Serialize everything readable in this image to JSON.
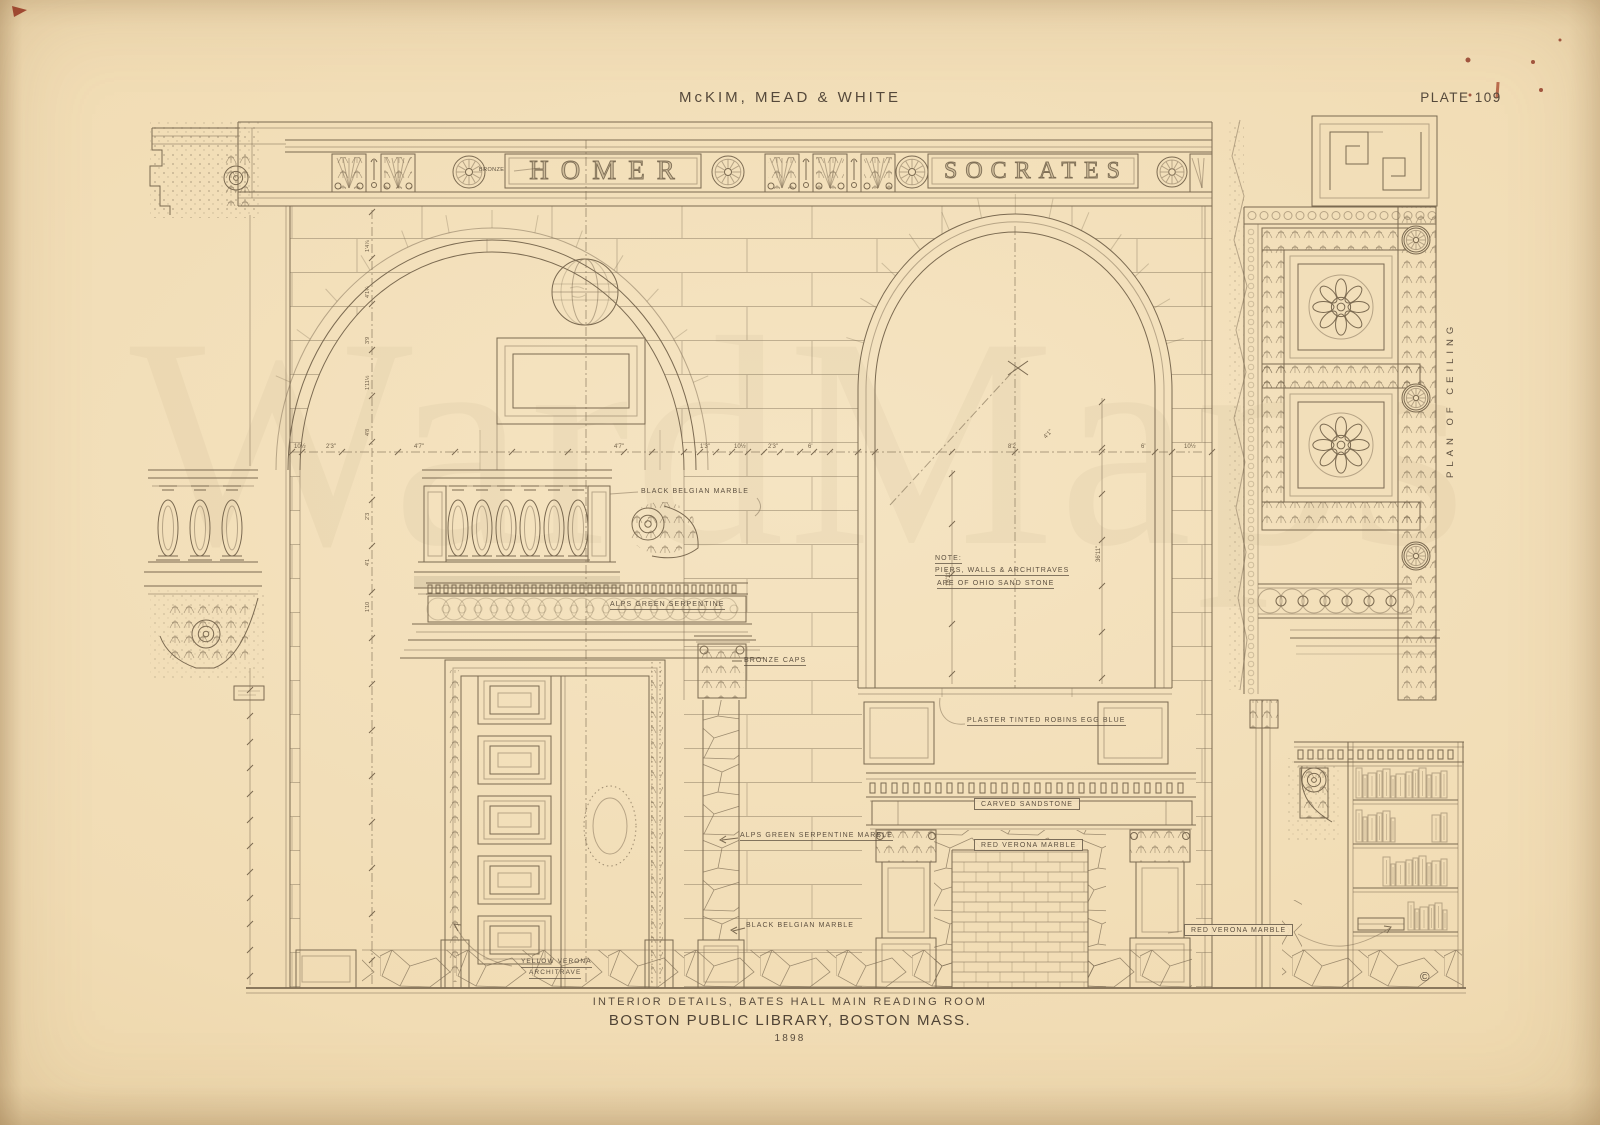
{
  "page": {
    "title": "McKIM, MEAD & WHITE",
    "plate": "PLATE 109",
    "caption_line1": "INTERIOR DETAILS, BATES HALL MAIN READING ROOM",
    "caption_line2": "BOSTON PUBLIC LIBRARY, BOSTON MASS.",
    "year": "1898",
    "copyright": "©",
    "watermark": "WardMaps"
  },
  "frieze": {
    "name_left": "HOMER",
    "name_right": "SOCRATES",
    "bronze": "BRONZE"
  },
  "labels": {
    "black_belgian_marble_upper": "BLACK BELGIAN MARBLE",
    "alps_green_serpentine": "ALPS GREEN SERPENTINE",
    "bronze_caps": "BRONZE CAPS",
    "note_heading": "NOTE:",
    "note_line1": "PIERS, WALLS & ARCHITRAVES",
    "note_line2": "ARE OF OHIO SAND STONE",
    "plaster": "PLASTER TINTED ROBINS EGG BLUE",
    "carved_sandstone": "CARVED SANDSTONE",
    "red_verona_marble": "RED VERONA MARBLE",
    "alps_green_serpentine_marble": "ALPS GREEN SERPENTINE MARBLE",
    "black_belgian_marble_lower": "BLACK BELGIAN MARBLE",
    "yellow_verona_line1": "YELLOW VERONA",
    "yellow_verona_line2": "ARCHITRAVE",
    "red_verona_marble_bookcase": "RED VERONA MARBLE",
    "plan_of_ceiling": "PLAN OF CEILING"
  },
  "dimensions": {
    "row": [
      "10½",
      "2'3\"",
      "4'7\"",
      "4'7\"",
      "1'3\"",
      "10½",
      "2'3\"",
      "6'",
      "8'2",
      "6'",
      "10½"
    ],
    "left_chain": [
      "1'4⅞",
      "4'1¼",
      "3'9",
      "1'11½",
      "4'8",
      "2'3",
      "4'1",
      "1'10"
    ],
    "niche_height": "36'11\"",
    "opening_height": "16'11\"",
    "arch_radius": "4'1\""
  },
  "colors": {
    "paper": "#f1dcb4",
    "ink": "#7b6a51",
    "text": "#5d5040",
    "speck_red": "#8e3322"
  }
}
